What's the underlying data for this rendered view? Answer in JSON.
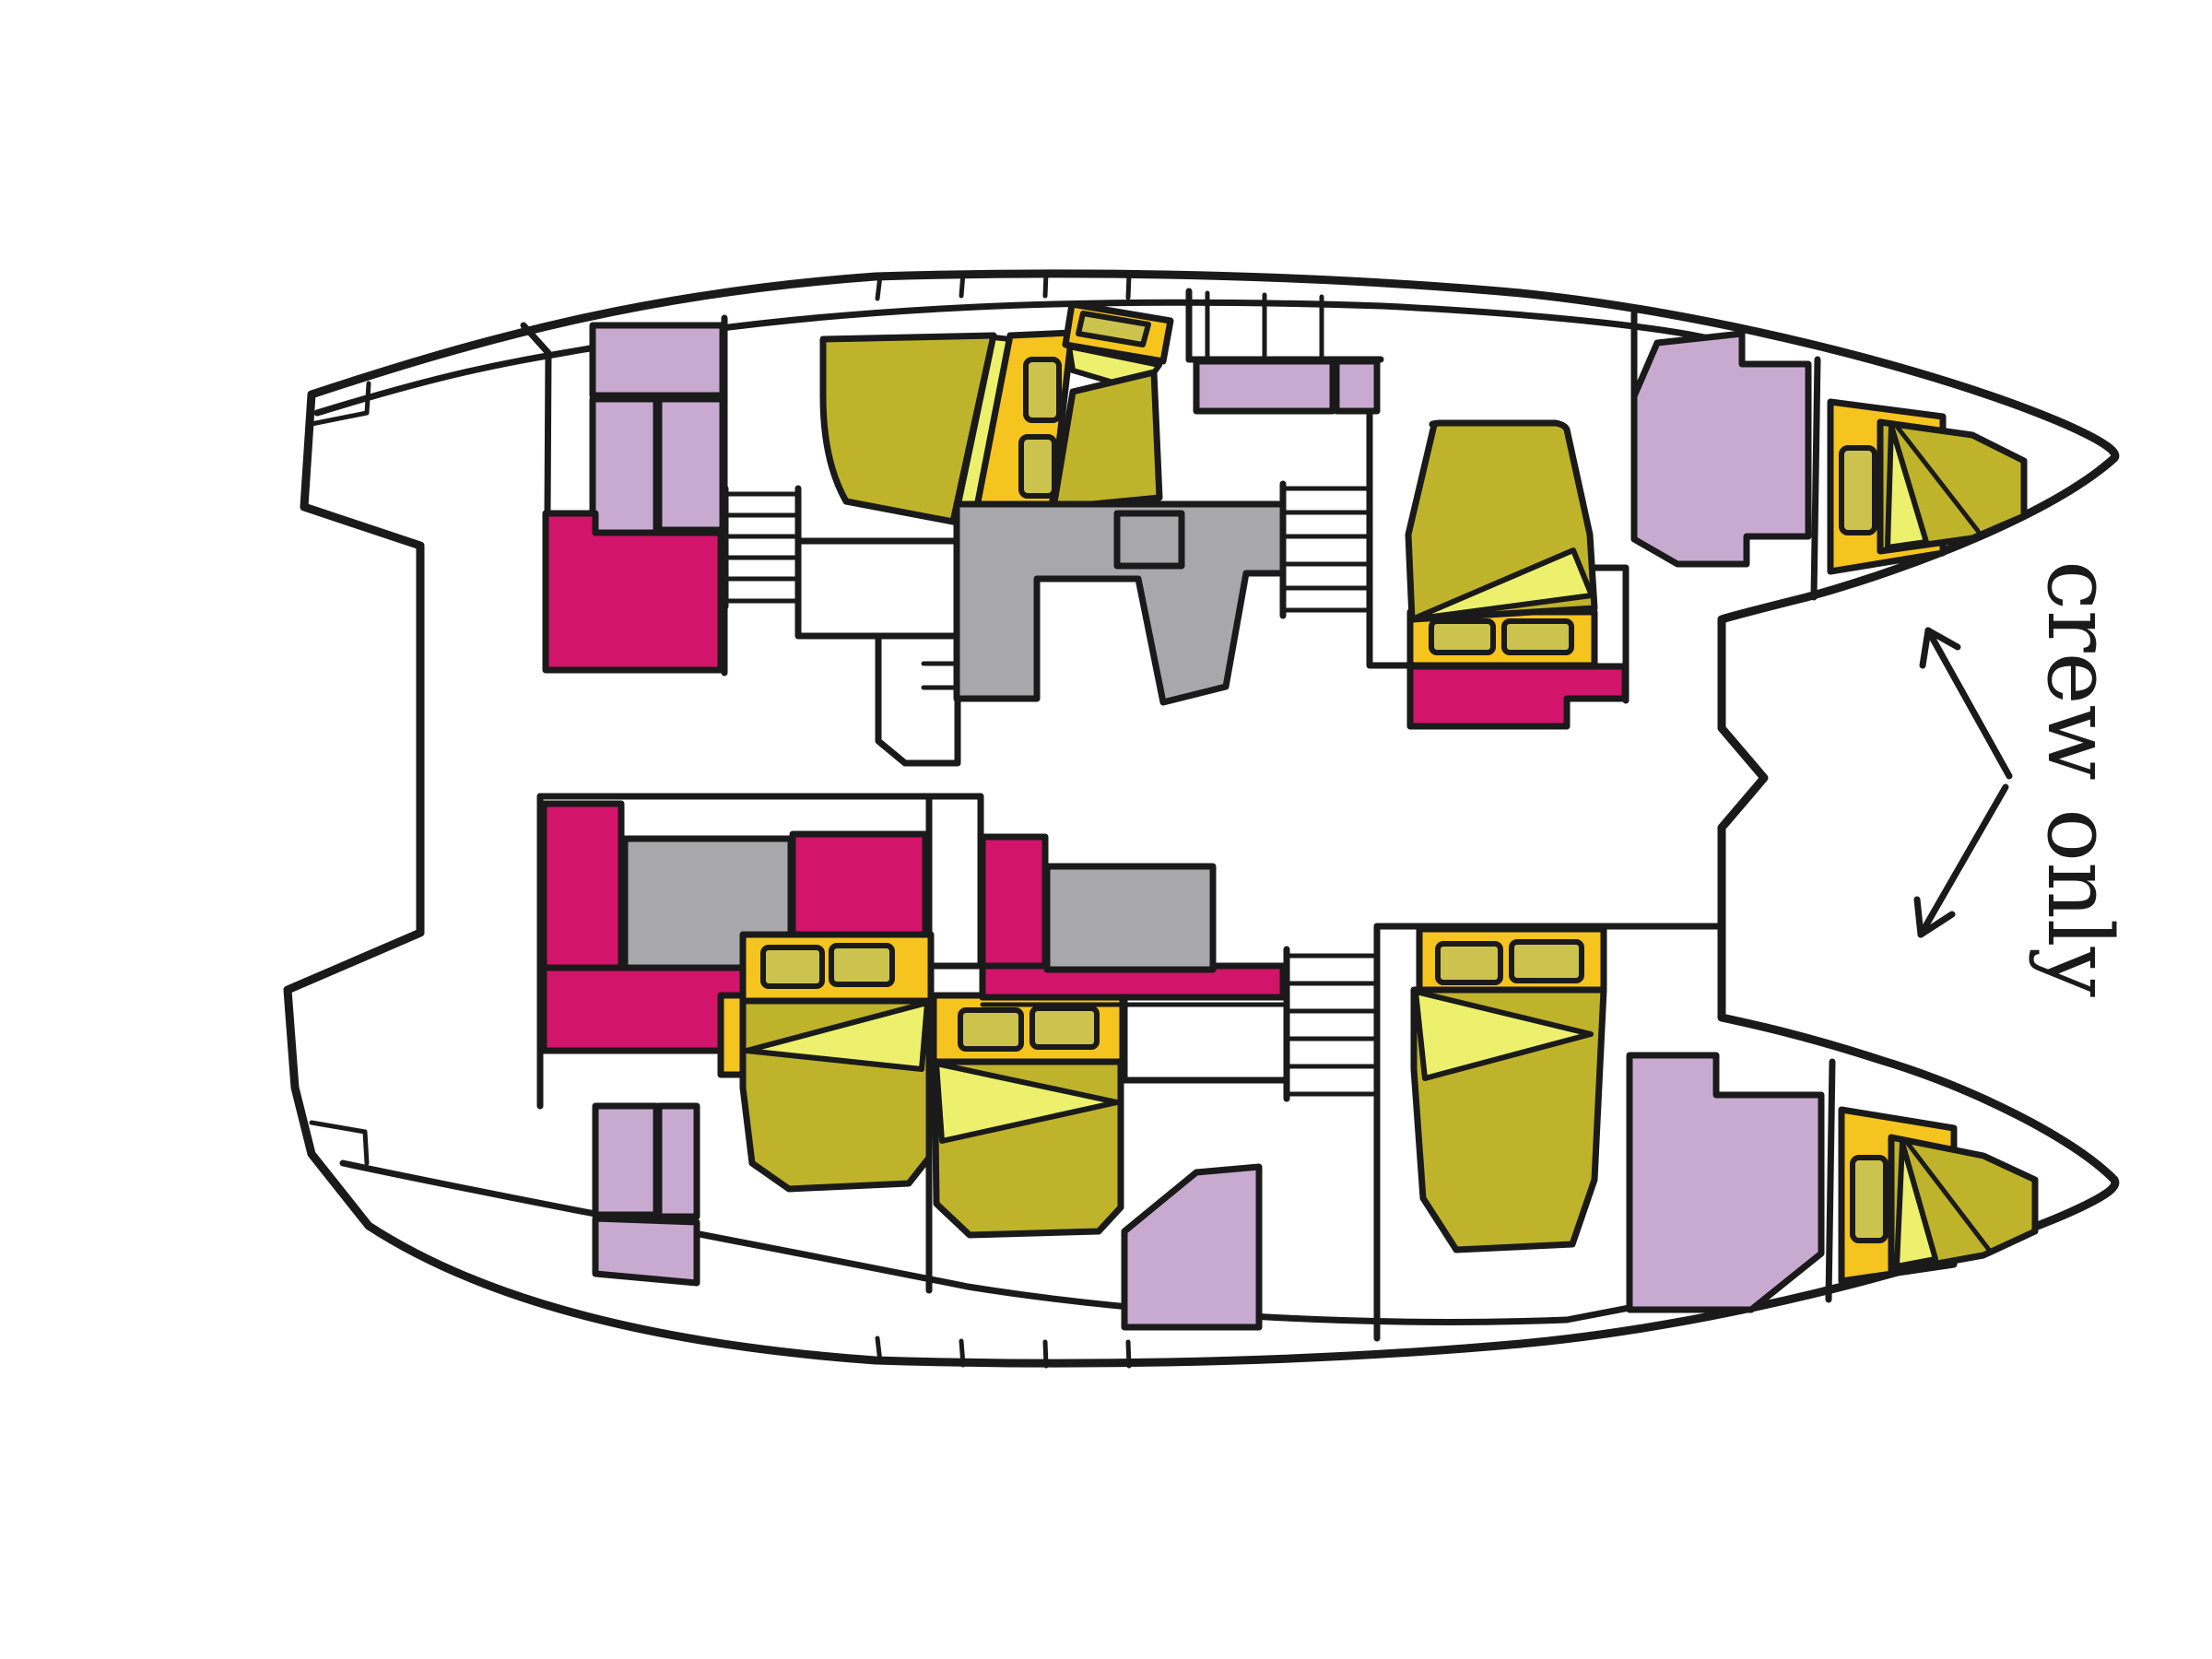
{
  "figure": {
    "type": "floor-plan",
    "subject": "catamaran cabin layout, top-down view, bow to the right"
  },
  "annotation": {
    "label": "crew only"
  },
  "colors": {
    "outline": "#1a1a1a",
    "background": "#ffffff",
    "hull": "#ffffff",
    "mattress_olive": "#bfb32b",
    "bed_frame_yellow": "#f6c41f",
    "blanket_fold_yellow": "#edf06c",
    "pillow_olive": "#ccc24e",
    "upholstery_pink": "#d2146a",
    "wardrobe_lavender": "#c8aad1",
    "counter_gray": "#a8a8ab",
    "text": "#1a1a1a"
  },
  "features": {
    "double_beds": 5,
    "crew_beds": 2,
    "staircases": 3,
    "pink_seating_or_bath_areas": 4,
    "gray_counter_tables": 3,
    "wardrobe_units": 10
  }
}
